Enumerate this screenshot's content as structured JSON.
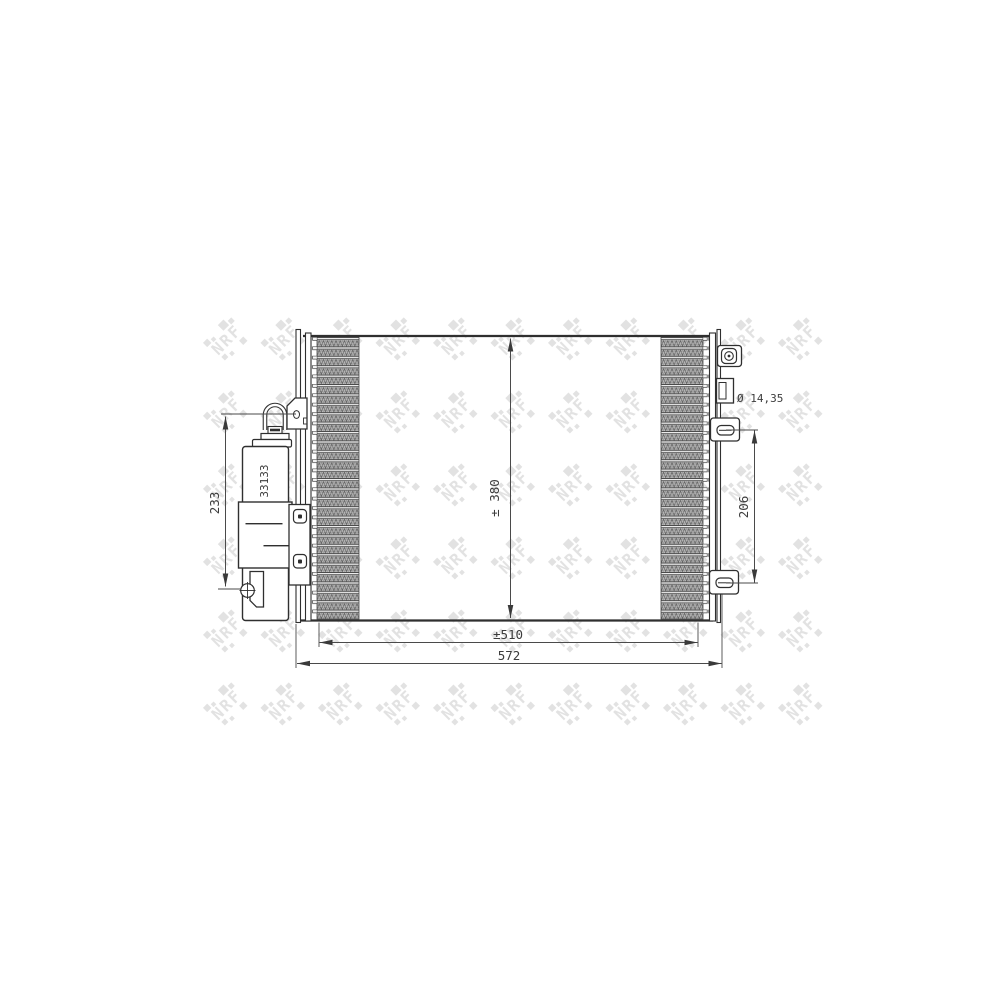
{
  "drawing": {
    "type": "condenser-technical-drawing",
    "brand_watermark": "NRF",
    "part_number": "33133",
    "dimensions": {
      "core_height": "± 380",
      "core_width": "±510",
      "total_width": "572",
      "drier_height": "233",
      "mount_span": "206",
      "pin_diameter": "Ø 14,35"
    },
    "colors": {
      "line": "#2f2f2f",
      "dim": "#4a4a4a",
      "wm": "#e2e2e2",
      "bg": "#ffffff",
      "text": "#3c3c3c"
    }
  }
}
